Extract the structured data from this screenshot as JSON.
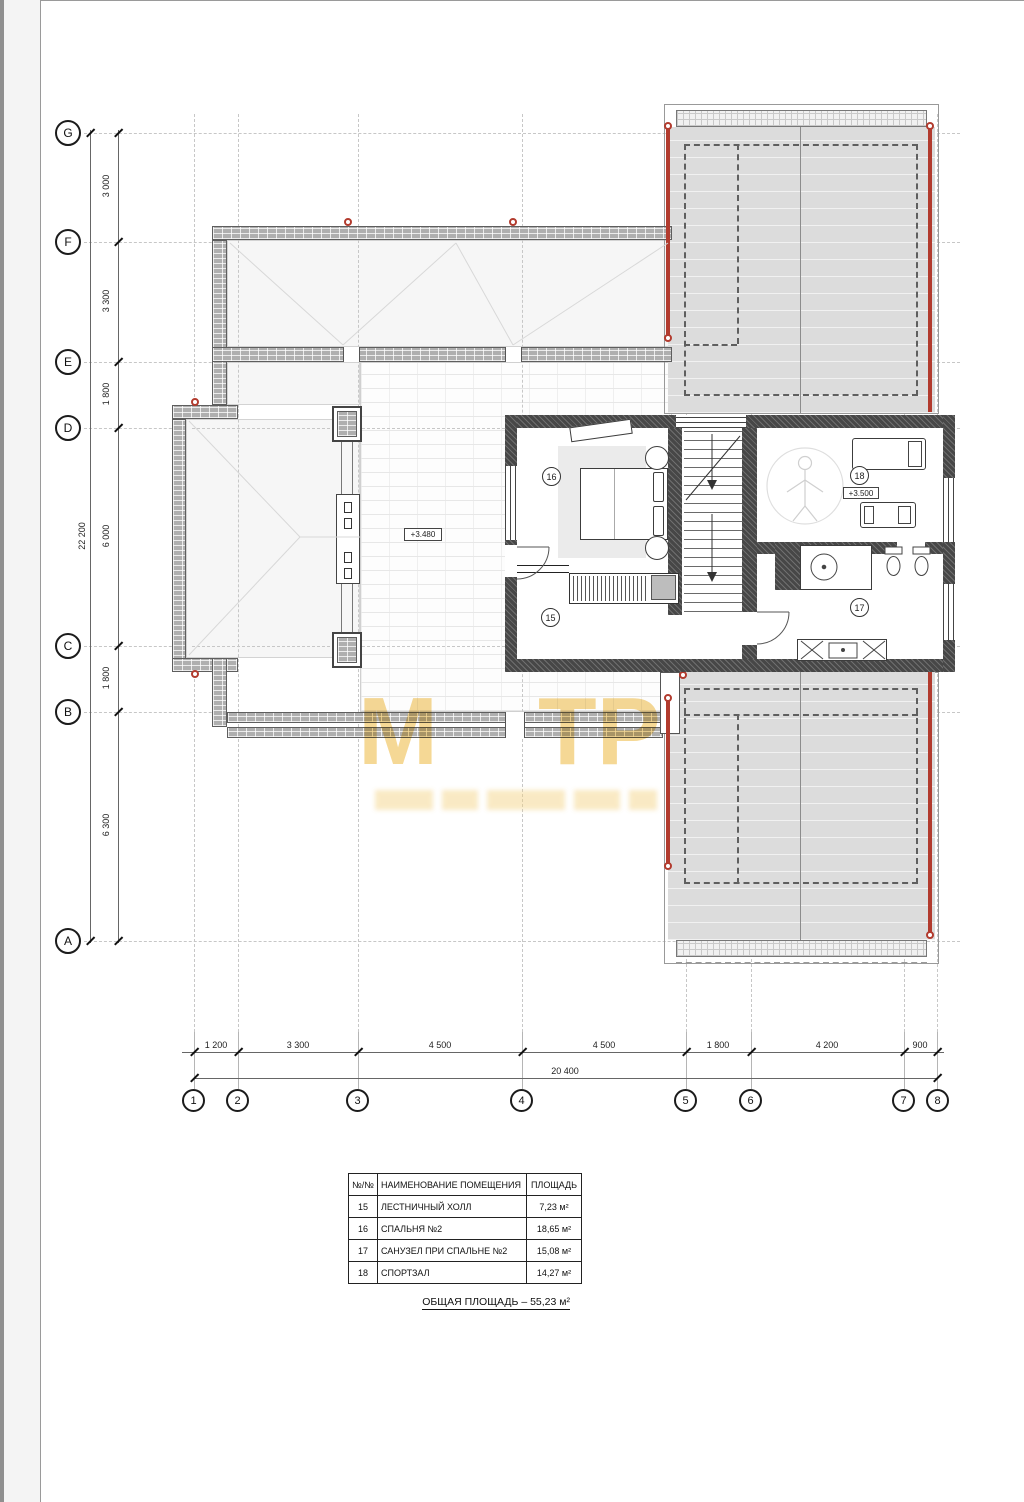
{
  "axes": {
    "rows": [
      {
        "label": "G"
      },
      {
        "label": "F"
      },
      {
        "label": "E"
      },
      {
        "label": "D"
      },
      {
        "label": "C"
      },
      {
        "label": "B"
      },
      {
        "label": "A"
      }
    ],
    "cols": [
      {
        "label": "1"
      },
      {
        "label": "2"
      },
      {
        "label": "3"
      },
      {
        "label": "4"
      },
      {
        "label": "5"
      },
      {
        "label": "6"
      },
      {
        "label": "7"
      },
      {
        "label": "8"
      }
    ],
    "left_dims": [
      "3 000",
      "3 300",
      "1 800",
      "6 000",
      "1 800",
      "6 300"
    ],
    "left_total": "22 200",
    "bottom_dims": [
      "1 200",
      "3 300",
      "4 500",
      "4 500",
      "1 800",
      "4 200",
      "900"
    ],
    "bottom_total": "20 400"
  },
  "rooms": {
    "hall_number": "15",
    "bedroom_number": "16",
    "bath_number": "17",
    "gym_number": "18",
    "level_terrace": "+3.480",
    "level_gym": "+3.500"
  },
  "legend_table": {
    "headers": [
      "№/№",
      "НАИМЕНОВАНИЕ ПОМЕЩЕНИЯ",
      "ПЛОЩАДЬ"
    ],
    "rows": [
      {
        "num": "15",
        "name": "ЛЕСТНИЧНЫЙ ХОЛЛ",
        "area": "7,23 м²"
      },
      {
        "num": "16",
        "name": "СПАЛЬНЯ №2",
        "area": "18,65 м²"
      },
      {
        "num": "17",
        "name": "САНУЗЕЛ ПРИ СПАЛЬНЕ №2",
        "area": "15,08 м²"
      },
      {
        "num": "18",
        "name": "СПОРТЗАЛ",
        "area": "14,27 м²"
      }
    ],
    "total": "ОБЩАЯ ПЛОЩАДЬ – 55,23 м²"
  },
  "watermark": {
    "part1": "М",
    "part2": "ТР"
  },
  "colors": {
    "accent_red": "#b23b2e",
    "watermark_yellow": "#f3d07e",
    "roof_grey": "#dcdcdc"
  }
}
